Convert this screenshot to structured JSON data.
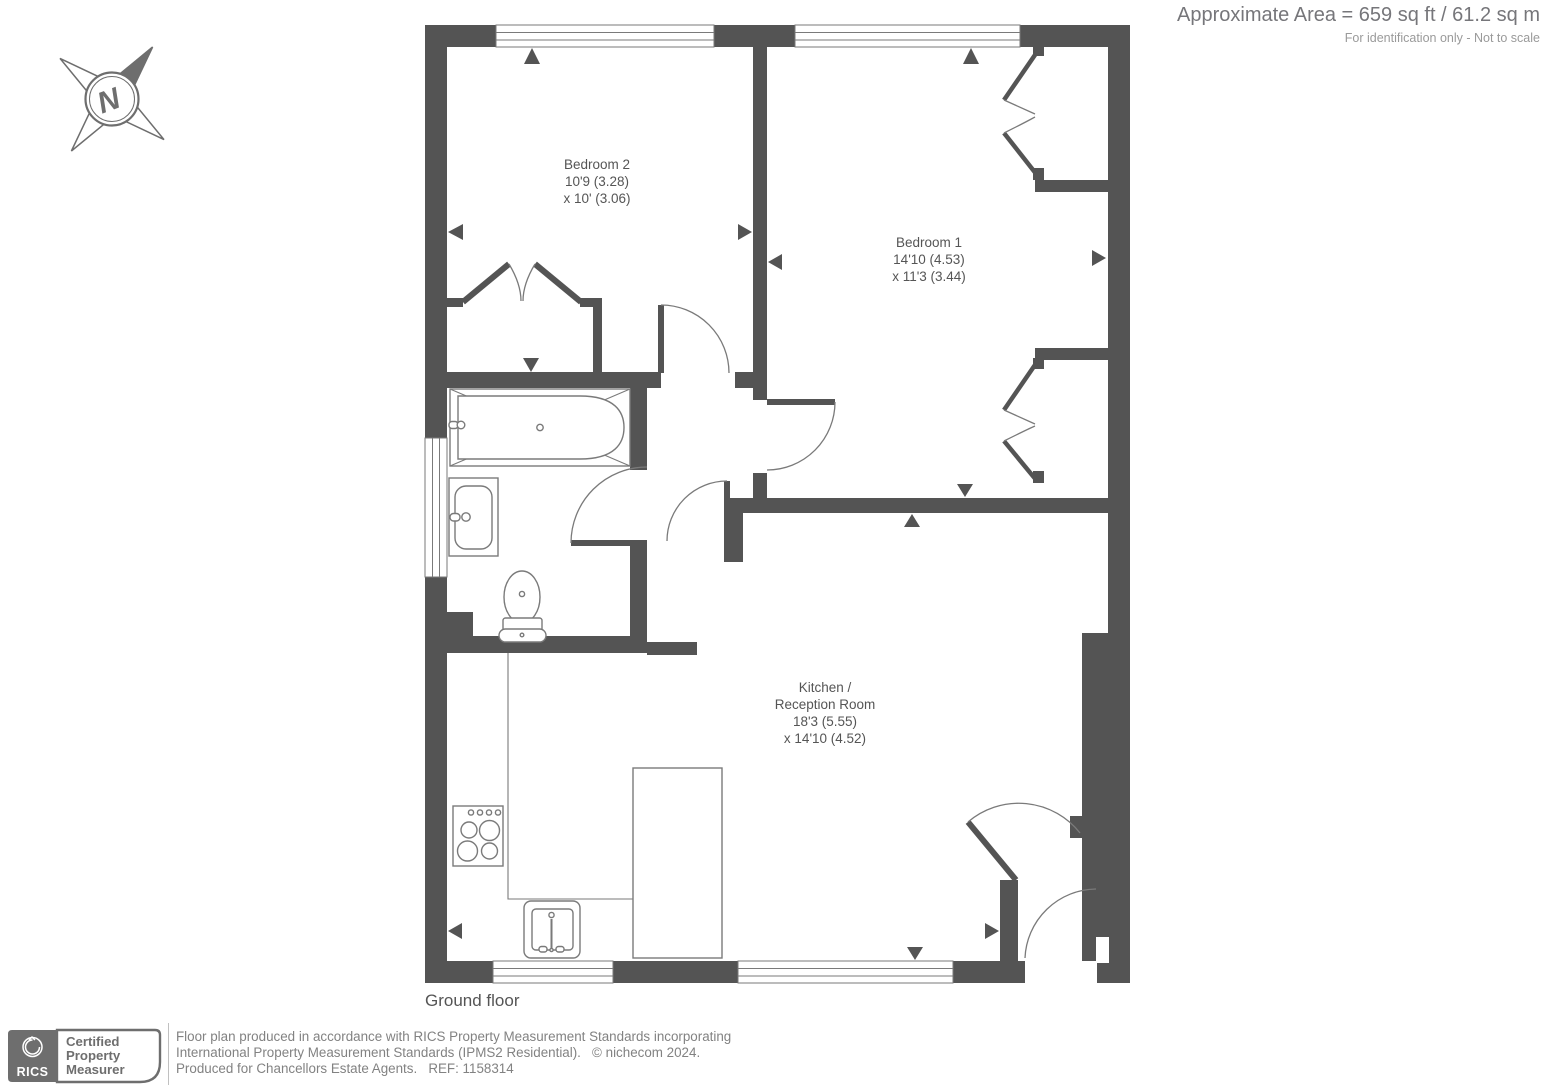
{
  "header": {
    "area": "Approximate Area = 659 sq ft / 61.2 sq m",
    "disclaimer": "For identification only - Not to scale"
  },
  "compass": {
    "letter": "N"
  },
  "plan": {
    "floor_label": "Ground floor",
    "rooms": [
      {
        "name": "Bedroom 2",
        "dim_line1": "10'9 (3.28)",
        "dim_line2": "x 10' (3.06)"
      },
      {
        "name": "Bedroom 1",
        "dim_line1": "14'10 (4.53)",
        "dim_line2": "x 11'3 (3.44)"
      },
      {
        "name_line1": "Kitchen /",
        "name_line2": "Reception Room",
        "dim_line1": "18'3 (5.55)",
        "dim_line2": "x 14'10 (4.52)"
      }
    ]
  },
  "footer": {
    "badge": {
      "brand": "RICS",
      "label_line1": "Certified",
      "label_line2": "Property",
      "label_line3": "Measurer"
    },
    "text_line1": "Floor plan produced in accordance with RICS Property Measurement Standards incorporating",
    "text_line2": "International Property Measurement Standards (IPMS2 Residential).   © nichecom 2024.",
    "text_line3": "Produced for Chancellors Estate Agents.   REF: 1158314"
  },
  "colors": {
    "wall": "#545454",
    "fixture_line": "#7a7a7a",
    "text_dark": "#555555",
    "text_mid": "#828282",
    "text_light": "#9a9a9a",
    "badge_gray": "#6e6e6e"
  }
}
